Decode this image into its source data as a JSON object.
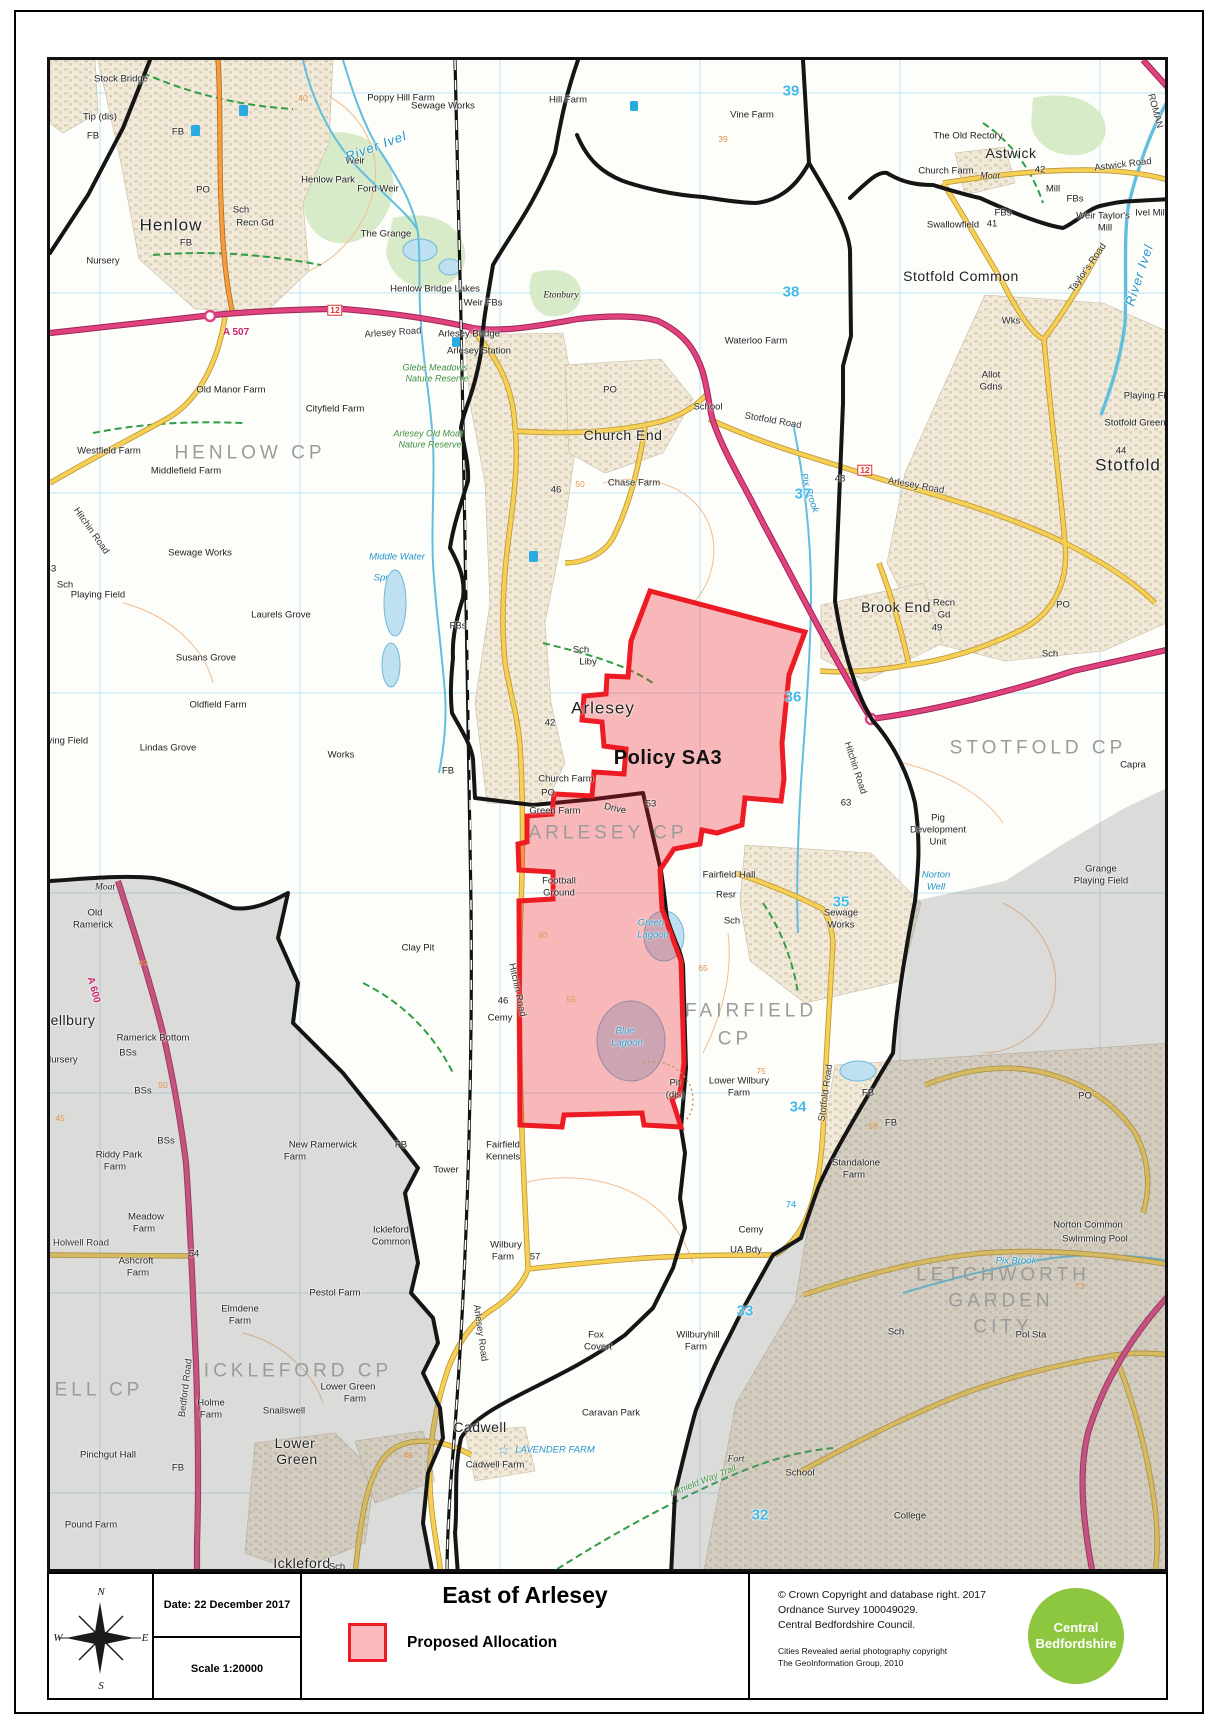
{
  "document": {
    "kind": "council-planning-map"
  },
  "title_block": {
    "compass": {
      "north": "N",
      "south": "S",
      "east": "E",
      "west": "W"
    },
    "date_label": "Date: 22 December 2017",
    "scale_label": "Scale  1:20000",
    "title": "East of Arlesey",
    "legend": [
      {
        "label": "Proposed Allocation",
        "swatch_fill": "rgba(237,28,36,0.30)",
        "swatch_border": "#ed1c24"
      }
    ],
    "copyright_lines": [
      "© Crown Copyright and database right.  2017",
      "Ordnance Survey 100049029.",
      "Central Bedfordshire Council."
    ],
    "aerial_lines": [
      "Cities Revealed aerial photography copyright",
      "The GeoInformation Group, 2010"
    ],
    "logo": {
      "line1": "Central",
      "line2": "Bedfordshire",
      "color": "#8dc63f"
    }
  },
  "map": {
    "policy_area_label": "Policy SA3",
    "colors": {
      "allocation_border": "#ed1c24",
      "allocation_fill": "rgba(237,28,36,0.30)",
      "grid_line": "#c9e8f6",
      "grid_number": "#45b9e8",
      "a_road": "#e0427e",
      "b_road": "#f59d3d",
      "minor_road": "#f6cf55",
      "water": "#62bede",
      "parish_text": "#9b9b9b",
      "outside_area_mask": "rgba(128,128,128,0.27)"
    },
    "labels": [
      [
        "Stock Bridge",
        118,
        76,
        "small"
      ],
      [
        "Tip (dis)",
        97,
        114,
        "small"
      ],
      [
        "FB",
        90,
        133,
        "small"
      ],
      [
        "Poppy Hill Farm",
        398,
        95,
        "small"
      ],
      [
        "Sewage Works",
        440,
        103,
        "small"
      ],
      [
        "Hill Farm",
        565,
        97,
        "small"
      ],
      [
        "Vine Farm",
        749,
        112,
        "small"
      ],
      [
        "39",
        720,
        136,
        "contour"
      ],
      [
        "The Old Rectory",
        965,
        133,
        "small"
      ],
      [
        "Church Farm",
        943,
        168,
        "small"
      ],
      [
        "Astwick",
        1008,
        150,
        "place14"
      ],
      [
        "42",
        1037,
        167,
        "small"
      ],
      [
        "Moat",
        987,
        174,
        "antiq"
      ],
      [
        "Astwick Road",
        1120,
        162,
        "road",
        -7
      ],
      [
        "Mill",
        1050,
        186,
        "small"
      ],
      [
        "FBs",
        1072,
        196,
        "small"
      ],
      [
        "Swallowfield",
        950,
        222,
        "small"
      ],
      [
        "41",
        989,
        221,
        "small"
      ],
      [
        "FBs",
        1000,
        210,
        "small"
      ],
      [
        "Weir Taylor's",
        1100,
        213,
        "small"
      ],
      [
        "Mill",
        1102,
        225,
        "small"
      ],
      [
        "Ivel Mill",
        1148,
        210,
        "small"
      ],
      [
        "ROMAN",
        1152,
        108,
        "road",
        75
      ],
      [
        "River Ivel",
        1136,
        272,
        "water-lg",
        -72
      ],
      [
        "Taylor's Road",
        1085,
        265,
        "road",
        -55
      ],
      [
        "Wks",
        1008,
        318,
        "small"
      ],
      [
        "Stotfold Common",
        958,
        273,
        "place14"
      ],
      [
        "Waterloo Farm",
        753,
        338,
        "small"
      ],
      [
        "Henlow",
        168,
        222,
        "town"
      ],
      [
        "Henlow Park",
        325,
        177,
        "small"
      ],
      [
        "Weir",
        352,
        158,
        "small"
      ],
      [
        "Ford Weir",
        375,
        186,
        "small"
      ],
      [
        "River Ivel",
        373,
        143,
        "water-lg",
        -20
      ],
      [
        "The Grange",
        383,
        231,
        "small"
      ],
      [
        "PO",
        200,
        187,
        "small"
      ],
      [
        "Sch",
        238,
        207,
        "small"
      ],
      [
        "Recn Gd",
        252,
        220,
        "small"
      ],
      [
        "Nursery",
        100,
        258,
        "small"
      ],
      [
        "FB",
        175,
        129,
        "small"
      ],
      [
        "FB",
        183,
        240,
        "small"
      ],
      [
        "A 507",
        233,
        330,
        "aroad"
      ],
      [
        "12",
        332,
        307,
        "shield"
      ],
      [
        "Arlesey Road",
        390,
        330,
        "road",
        -4
      ],
      [
        "Old Manor Farm",
        228,
        387,
        "small"
      ],
      [
        "Cityfield Farm",
        332,
        406,
        "small"
      ],
      [
        "Westfield Farm",
        106,
        448,
        "small"
      ],
      [
        "Middlefield Farm",
        183,
        468,
        "small"
      ],
      [
        "HENLOW CP",
        247,
        450,
        "parish"
      ],
      [
        "Sewage Works",
        197,
        550,
        "small"
      ],
      [
        "Hitchin Road",
        88,
        528,
        "road",
        55
      ],
      [
        "43",
        48,
        566,
        "small"
      ],
      [
        "Middle Water",
        394,
        554,
        "water"
      ],
      [
        "Spr",
        378,
        575,
        "water"
      ],
      [
        "Playing Field",
        95,
        592,
        "small"
      ],
      [
        "Sch",
        62,
        582,
        "small"
      ],
      [
        "Laurels Grove",
        278,
        612,
        "small"
      ],
      [
        "Susans Grove",
        203,
        655,
        "small"
      ],
      [
        "Oldfield Farm",
        215,
        702,
        "small"
      ],
      [
        "Lindas Grove",
        165,
        745,
        "small"
      ],
      [
        "Playing Field",
        58,
        738,
        "small"
      ],
      [
        "Works",
        338,
        752,
        "small"
      ],
      [
        "Clay Pit",
        415,
        945,
        "small"
      ],
      [
        "Henlow Bridge Lakes",
        432,
        286,
        "small"
      ],
      [
        "Weir FBs",
        480,
        300,
        "small"
      ],
      [
        "Arlesey Bridge",
        466,
        331,
        "small"
      ],
      [
        "Arlesey Station",
        476,
        348,
        "small"
      ],
      [
        "Glebe Meadows",
        432,
        365,
        "green"
      ],
      [
        "Nature Reserve",
        434,
        376,
        "green"
      ],
      [
        "Arlesey Old Moat",
        425,
        431,
        "green"
      ],
      [
        "Nature Reserve",
        427,
        442,
        "green"
      ],
      [
        "Etonbury",
        558,
        293,
        "antiq"
      ],
      [
        "Church End",
        620,
        432,
        "place14"
      ],
      [
        "School",
        705,
        404,
        "small"
      ],
      [
        "Chase Farm",
        631,
        480,
        "small"
      ],
      [
        "46",
        553,
        487,
        "small"
      ],
      [
        "50",
        577,
        481,
        "contour"
      ],
      [
        "PO",
        607,
        387,
        "small"
      ],
      [
        "Arlesey",
        600,
        705,
        "town"
      ],
      [
        "Sch",
        578,
        647,
        "small"
      ],
      [
        "Liby",
        585,
        659,
        "small"
      ],
      [
        "FBs",
        455,
        623,
        "small"
      ],
      [
        "42",
        547,
        720,
        "small"
      ],
      [
        "Church Farm",
        563,
        776,
        "small"
      ],
      [
        "PO",
        545,
        790,
        "small"
      ],
      [
        "FB",
        445,
        768,
        "small"
      ],
      [
        "Policy SA3",
        665,
        755,
        "policy"
      ],
      [
        "ARLESEY CP",
        605,
        830,
        "parish"
      ],
      [
        "Green Farm",
        552,
        808,
        "small"
      ],
      [
        "Drive",
        612,
        806,
        "small",
        12
      ],
      [
        "53",
        648,
        801,
        "small"
      ],
      [
        "Football",
        556,
        878,
        "small"
      ],
      [
        "Ground",
        556,
        890,
        "small"
      ],
      [
        "Green",
        648,
        920,
        "water"
      ],
      [
        "Lagoon",
        650,
        932,
        "water"
      ],
      [
        "Blue",
        622,
        1028,
        "water"
      ],
      [
        "Lagoon",
        624,
        1040,
        "water"
      ],
      [
        "Hitchin Road",
        514,
        987,
        "road",
        78
      ],
      [
        "46",
        500,
        998,
        "small"
      ],
      [
        "Cemy",
        497,
        1015,
        "small"
      ],
      [
        "Fairfield Hall",
        726,
        872,
        "small"
      ],
      [
        "Resr",
        723,
        892,
        "small"
      ],
      [
        "Sch",
        729,
        918,
        "small"
      ],
      [
        "FAIRFIELD",
        748,
        1008,
        "parish"
      ],
      [
        "CP",
        732,
        1036,
        "parish"
      ],
      [
        "Pit",
        672,
        1080,
        "small"
      ],
      [
        "(dis)",
        672,
        1092,
        "small"
      ],
      [
        "Lower Wilbury",
        736,
        1078,
        "small"
      ],
      [
        "Farm",
        736,
        1090,
        "small"
      ],
      [
        "75",
        758,
        1068,
        "contour"
      ],
      [
        "Fairfield",
        500,
        1142,
        "small"
      ],
      [
        "Kennels",
        500,
        1154,
        "small"
      ],
      [
        "Tower",
        443,
        1167,
        "small"
      ],
      [
        "FB",
        398,
        1142,
        "small"
      ],
      [
        "Wilbury",
        503,
        1242,
        "small"
      ],
      [
        "Farm",
        500,
        1254,
        "small"
      ],
      [
        "57",
        532,
        1254,
        "small"
      ],
      [
        "Fox",
        593,
        1332,
        "small"
      ],
      [
        "Covert",
        595,
        1344,
        "small"
      ],
      [
        "Arlesey Road",
        477,
        1330,
        "road",
        82
      ],
      [
        "Wilburyhill",
        695,
        1332,
        "small"
      ],
      [
        "Farm",
        693,
        1344,
        "small"
      ],
      [
        "Cemy",
        748,
        1227,
        "small"
      ],
      [
        "UA Bdy",
        743,
        1247,
        "small"
      ],
      [
        "Icknield Way Trail",
        700,
        1478,
        "green",
        -22
      ],
      [
        "Stotfold Road",
        770,
        418,
        "road",
        10
      ],
      [
        "Allot",
        988,
        372,
        "small"
      ],
      [
        "Gdns",
        988,
        384,
        "small"
      ],
      [
        "Playing Field",
        1148,
        393,
        "small"
      ],
      [
        "Stotfold Green",
        1132,
        420,
        "small"
      ],
      [
        "Stotfold",
        1125,
        462,
        "town"
      ],
      [
        "44",
        1118,
        448,
        "small"
      ],
      [
        "Arlesey Road",
        913,
        483,
        "road",
        10
      ],
      [
        "12",
        862,
        467,
        "shield"
      ],
      [
        "48",
        837,
        476,
        "small"
      ],
      [
        "Pix Brook",
        806,
        490,
        "water",
        72
      ],
      [
        "Brook End",
        893,
        604,
        "place14"
      ],
      [
        "Recn",
        941,
        600,
        "small"
      ],
      [
        "Gd",
        941,
        612,
        "small"
      ],
      [
        "49",
        934,
        625,
        "small"
      ],
      [
        "Sch",
        1047,
        651,
        "small"
      ],
      [
        "PO",
        1060,
        602,
        "small"
      ],
      [
        "STOTFOLD CP",
        1035,
        745,
        "parish"
      ],
      [
        "Capra",
        1130,
        762,
        "small"
      ],
      [
        "Hitchin Road",
        852,
        765,
        "road",
        72
      ],
      [
        "63",
        843,
        800,
        "small"
      ],
      [
        "Pig",
        935,
        815,
        "small"
      ],
      [
        "Development",
        935,
        827,
        "small"
      ],
      [
        "Unit",
        935,
        839,
        "small"
      ],
      [
        "Norton",
        933,
        872,
        "water"
      ],
      [
        "Well",
        933,
        884,
        "water"
      ],
      [
        "Sewage",
        838,
        910,
        "small"
      ],
      [
        "Works",
        838,
        922,
        "small"
      ],
      [
        "Grange",
        1098,
        866,
        "small"
      ],
      [
        "Playing Field",
        1098,
        878,
        "small"
      ],
      [
        "Pix Brook",
        1013,
        1258,
        "water"
      ],
      [
        "Stotfold Road",
        823,
        1090,
        "road",
        -82
      ],
      [
        "Standalone",
        853,
        1160,
        "small"
      ],
      [
        "Farm",
        851,
        1172,
        "small"
      ],
      [
        "Norton Common",
        1085,
        1222,
        "small"
      ],
      [
        "Swimming Pool",
        1092,
        1236,
        "small"
      ],
      [
        "73",
        1077,
        1283,
        "contour"
      ],
      [
        "LETCHWORTH",
        1000,
        1272,
        "parish"
      ],
      [
        "GARDEN",
        998,
        1298,
        "parish"
      ],
      [
        "CITY",
        1000,
        1324,
        "parish"
      ],
      [
        "Sch",
        893,
        1329,
        "small"
      ],
      [
        "Pol Sta",
        1028,
        1332,
        "small"
      ],
      [
        "PO",
        1082,
        1093,
        "small"
      ],
      [
        "FB",
        865,
        1090,
        "small"
      ],
      [
        "FB",
        888,
        1120,
        "small"
      ],
      [
        "58",
        870,
        1123,
        "contour"
      ],
      [
        "74",
        788,
        1202,
        "gridsm"
      ],
      [
        "Old",
        92,
        910,
        "small"
      ],
      [
        "Ramerick",
        90,
        922,
        "small"
      ],
      [
        "Moat",
        102,
        885,
        "antiq"
      ],
      [
        "ellbury",
        70,
        1017,
        "place14"
      ],
      [
        "Ramerick Bottom",
        150,
        1035,
        "small"
      ],
      [
        "BSs",
        125,
        1050,
        "small"
      ],
      [
        "BSs",
        140,
        1088,
        "small"
      ],
      [
        "BSs",
        163,
        1138,
        "small"
      ],
      [
        "Nursery",
        58,
        1057,
        "small"
      ],
      [
        "A 600",
        90,
        987,
        "aroad",
        75
      ],
      [
        "49",
        140,
        960,
        "contour"
      ],
      [
        "Riddy Park",
        116,
        1152,
        "small"
      ],
      [
        "Farm",
        112,
        1164,
        "small"
      ],
      [
        "New Ramerwick",
        320,
        1142,
        "small"
      ],
      [
        "Farm",
        292,
        1154,
        "small"
      ],
      [
        "Meadow",
        143,
        1214,
        "small"
      ],
      [
        "Farm",
        141,
        1226,
        "small"
      ],
      [
        "Holwell Road",
        78,
        1240,
        "road"
      ],
      [
        "54",
        191,
        1251,
        "small"
      ],
      [
        "Ashcroft",
        133,
        1258,
        "small"
      ],
      [
        "Farm",
        135,
        1270,
        "small"
      ],
      [
        "Elmdene",
        237,
        1306,
        "small"
      ],
      [
        "Farm",
        237,
        1318,
        "small"
      ],
      [
        "Pestol Farm",
        332,
        1290,
        "small"
      ],
      [
        "Ickleford",
        388,
        1227,
        "small"
      ],
      [
        "Common",
        388,
        1239,
        "small"
      ],
      [
        "ICKLEFORD CP",
        295,
        1368,
        "parish"
      ],
      [
        "WELL CP",
        85,
        1387,
        "parish"
      ],
      [
        "Bedford Road",
        183,
        1385,
        "road",
        -83
      ],
      [
        "Holme",
        208,
        1400,
        "small"
      ],
      [
        "Farm",
        208,
        1412,
        "small"
      ],
      [
        "Snailswell",
        281,
        1408,
        "small"
      ],
      [
        "Lower Green",
        345,
        1384,
        "small"
      ],
      [
        "Farm",
        352,
        1396,
        "small"
      ],
      [
        "Pinchgut Hall",
        105,
        1452,
        "small"
      ],
      [
        "Pound Farm",
        88,
        1522,
        "small"
      ],
      [
        "FB",
        175,
        1465,
        "small"
      ],
      [
        "Lower",
        292,
        1440,
        "place14"
      ],
      [
        "Green",
        294,
        1456,
        "place14"
      ],
      [
        "Ickleford",
        299,
        1560,
        "place14"
      ],
      [
        "Sch",
        334,
        1564,
        "small"
      ],
      [
        "Cadwell",
        477,
        1424,
        "place14"
      ],
      [
        "☆",
        500,
        1447,
        "water-lg"
      ],
      [
        "LAVENDER FARM",
        552,
        1447,
        "water"
      ],
      [
        "Cadwell Farm",
        492,
        1462,
        "small"
      ],
      [
        "48",
        405,
        1452,
        "contour"
      ],
      [
        "Caravan Park",
        608,
        1410,
        "small"
      ],
      [
        "College",
        907,
        1513,
        "small"
      ],
      [
        "School",
        797,
        1470,
        "small"
      ],
      [
        "Fort",
        733,
        1457,
        "antiq"
      ],
      [
        "55",
        568,
        996,
        "contour"
      ],
      [
        "60",
        540,
        932,
        "contour"
      ],
      [
        "65",
        700,
        965,
        "contour"
      ],
      [
        "45",
        57,
        1115,
        "contour"
      ],
      [
        "50",
        160,
        1082,
        "contour"
      ],
      [
        "40",
        300,
        95,
        "contour"
      ],
      [
        "39",
        788,
        88,
        "grid"
      ],
      [
        "38",
        788,
        289,
        "grid"
      ],
      [
        "37",
        800,
        491,
        "grid"
      ],
      [
        "36",
        790,
        694,
        "grid"
      ],
      [
        "35",
        838,
        899,
        "grid"
      ],
      [
        "34",
        795,
        1104,
        "grid"
      ],
      [
        "33",
        742,
        1308,
        "grid"
      ],
      [
        "32",
        757,
        1512,
        "grid"
      ]
    ]
  }
}
